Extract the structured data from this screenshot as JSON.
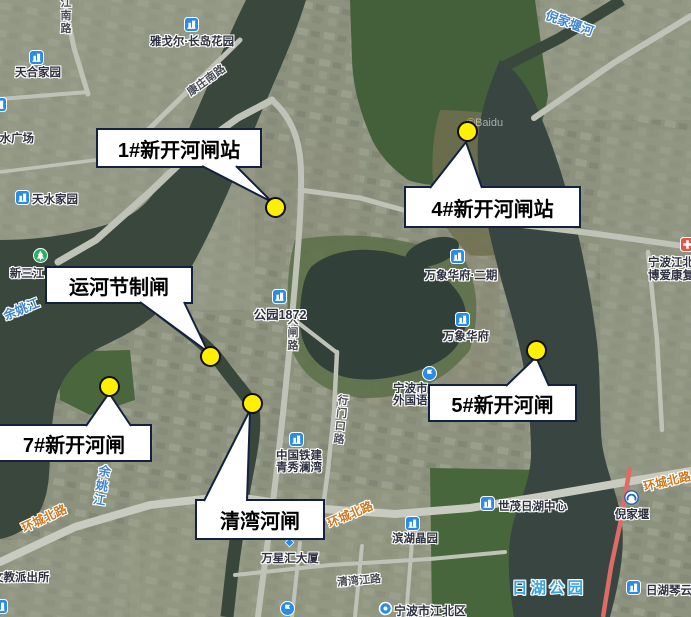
{
  "watermark": "©Baidu",
  "colors": {
    "marker_yellow": "#ffef00",
    "callout_border": "#13203f",
    "water": "#39463b",
    "water_label_blue": "#3f85cf",
    "park_label_blue": "#39a3dc",
    "road_label_orange": "#cd7a1f",
    "poi_icon_blue": "#2b8ce6",
    "red_road": "#de6b66"
  },
  "callouts": {
    "c1": {
      "label": "1#新开河闸站"
    },
    "c2": {
      "label": "4#新开河闸站"
    },
    "c3": {
      "label": "运河节制闸"
    },
    "c4": {
      "label": "7#新开河闸"
    },
    "c5": {
      "label": "5#新开河闸"
    },
    "c6": {
      "label": "清湾河闸"
    }
  },
  "pois": {
    "tianhe": {
      "label": "天合家园"
    },
    "yageer": {
      "label": "雅戈尔·长岛花园"
    },
    "tianshui_plaza": {
      "label": "天水广场"
    },
    "tianshui_home": {
      "label": "天水家园"
    },
    "xinsanjiang": {
      "label": "新三江"
    },
    "gongyuan1872": {
      "label": "公园1872"
    },
    "wanxiang2": {
      "label": "万象华府·二期"
    },
    "wanxiang": {
      "label": "万象华府"
    },
    "waiguoyu": {
      "line1": "宁波市",
      "line2": "外国语"
    },
    "tiejian": {
      "line1": "中国铁建",
      "line2": "青秀澜湾"
    },
    "shimao": {
      "label": "世茂日湖中心"
    },
    "nijiayan_station": {
      "label": "倪家堰"
    },
    "binhu": {
      "label": "滨湖晶园"
    },
    "wanxinghui": {
      "label": "万星汇大厦"
    },
    "rihuqinyun": {
      "label": "日湖琴云"
    },
    "jiangbei": {
      "label": "宁波市江北区"
    },
    "boai": {
      "line1": "宁波江北",
      "line2": "博爱康复"
    },
    "paichusuo": {
      "label": "文教派出所"
    }
  },
  "map_labels": {
    "yuyaojiang_1": "余姚江",
    "yuyaojiang_2": "余姚江",
    "nijiayanhe": "倪家堰河",
    "rihu_park": "日湖公园",
    "huancheng_1": "环城北路",
    "huancheng_2": "环城北路",
    "huancheng_3": "环城北路",
    "kangzhuang": "康庄南路",
    "jiangnan": "江南路",
    "dazha": "大闸路",
    "xingmenkou": "行门口路",
    "qingwanjiang": "清湾江路"
  }
}
